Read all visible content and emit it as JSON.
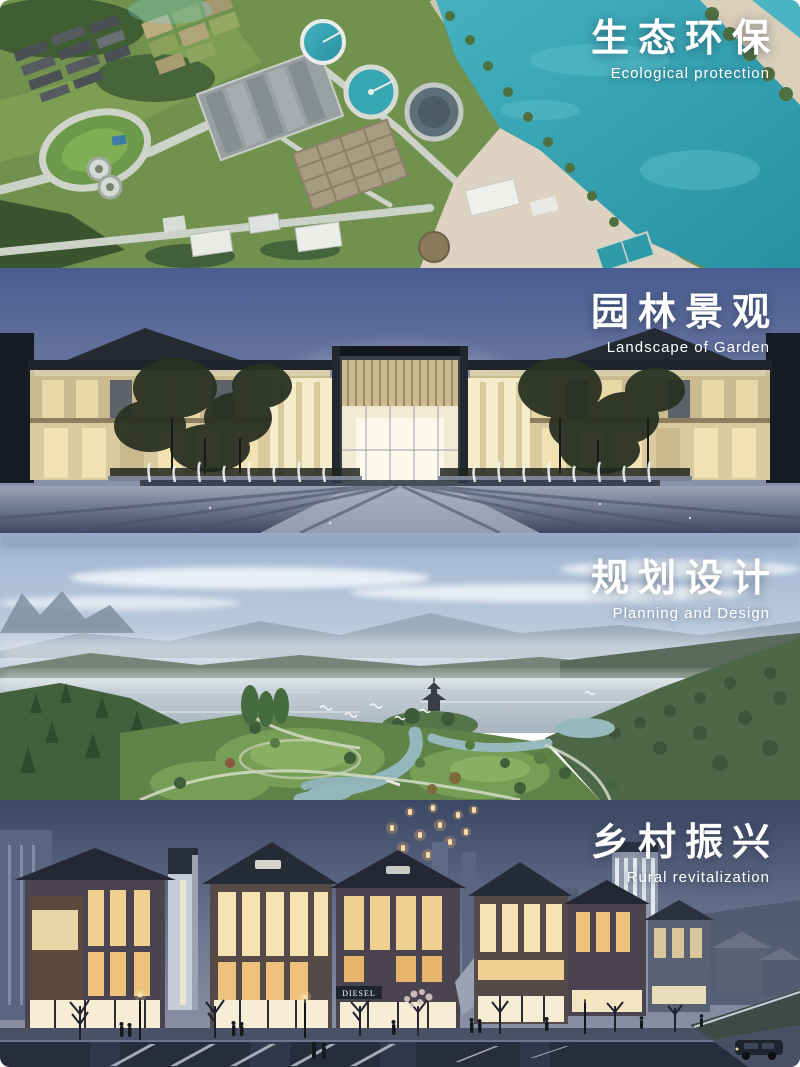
{
  "poster": {
    "sections": [
      {
        "key": "ecological",
        "title_zh": "生态环保",
        "title_en": "Ecological protection"
      },
      {
        "key": "garden",
        "title_zh": "园林景观",
        "title_en": "Landscape of Garden"
      },
      {
        "key": "planning",
        "title_zh": "规划设计",
        "title_en": "Planning and Design"
      },
      {
        "key": "rural",
        "title_zh": "乡村振兴",
        "title_en": "Rural revitalization"
      }
    ],
    "storefront_sign": "DIESEL",
    "colors": {
      "title_text": "#ffffff",
      "eco_river": "#2f9fae",
      "eco_grass": "#70924e",
      "garden_sky_top": "#4a5d92",
      "garden_facade": "#d9caa0",
      "planning_sky": "#a8bdd6",
      "rural_sky_top": "#3c4763",
      "lantern_glow": "#f8dcab"
    }
  }
}
